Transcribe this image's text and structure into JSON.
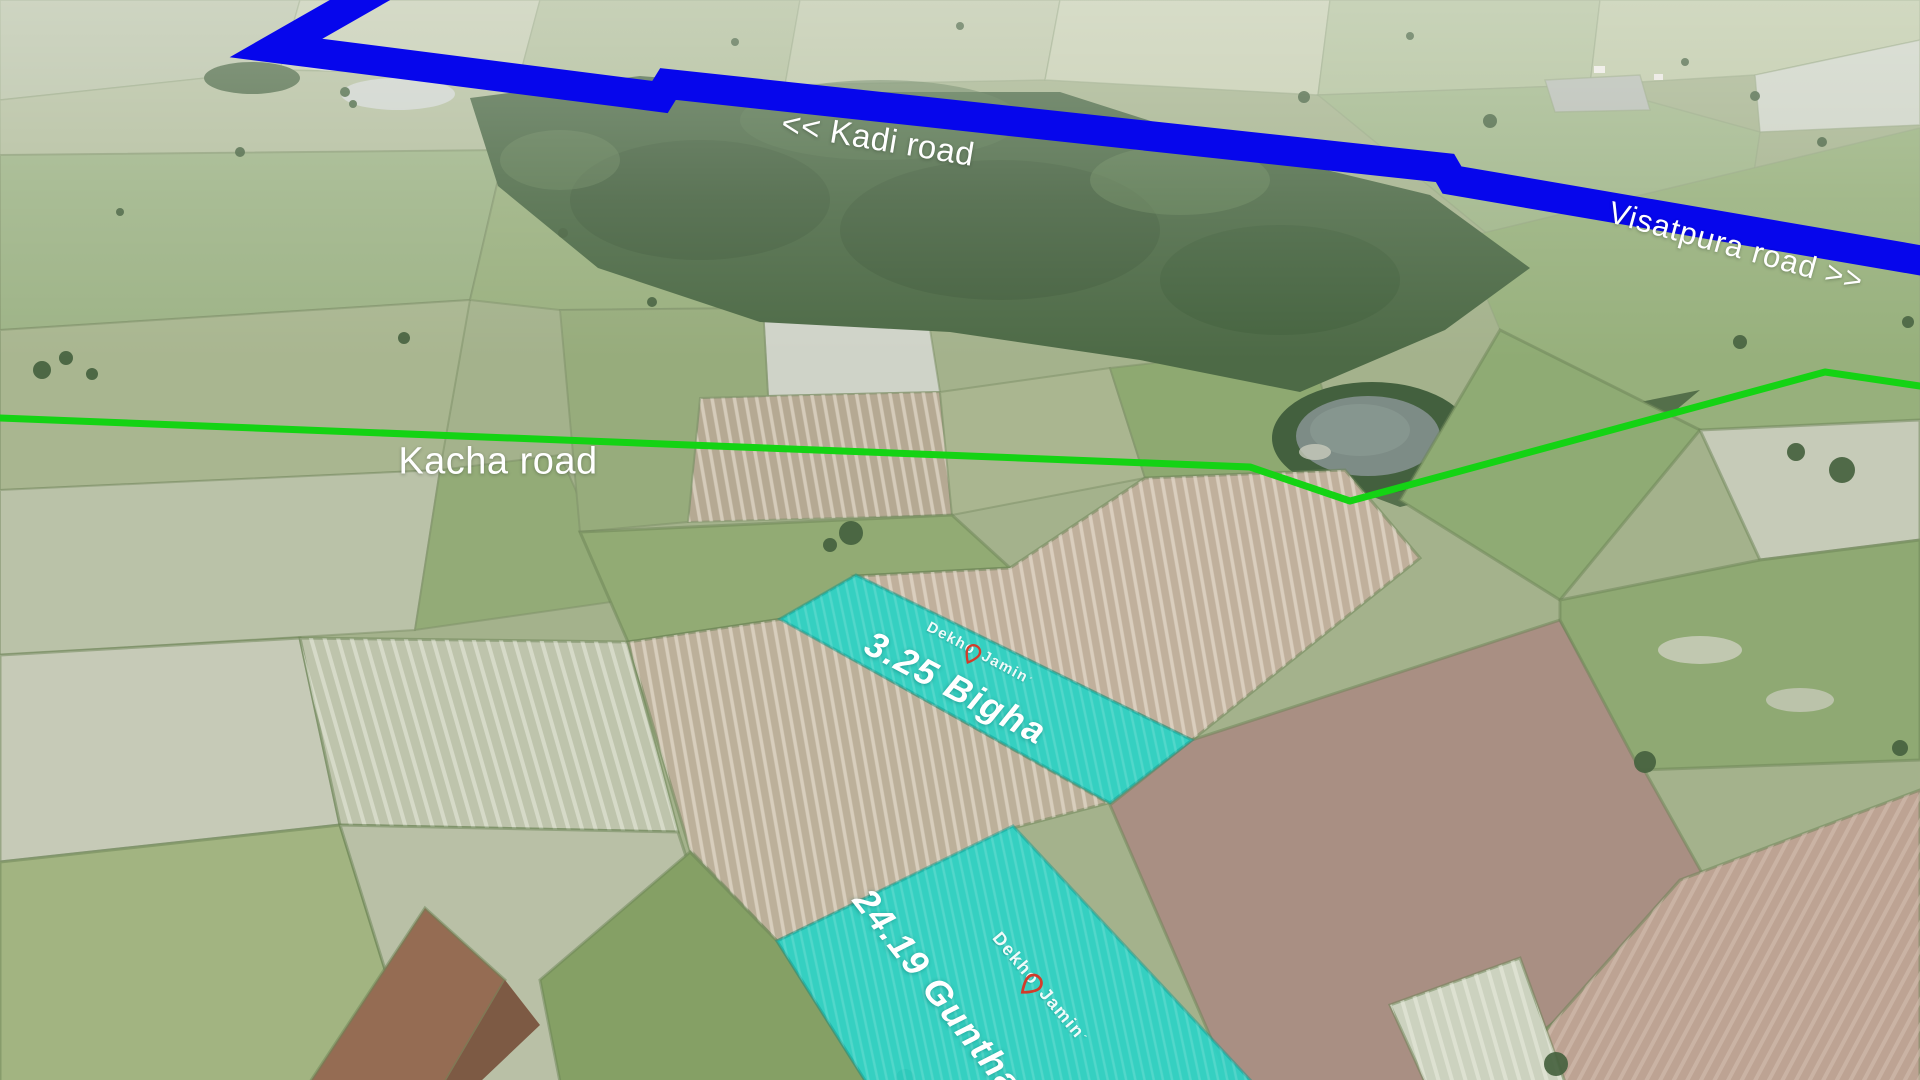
{
  "roads": {
    "blue_road": {
      "label_left": "<< Kadi road",
      "label_right": "Visatpura road >>",
      "color": "#0606ec"
    },
    "kacha": {
      "label": "Kacha road",
      "color": "#14d314"
    }
  },
  "plots": [
    {
      "area_label": "3.25 Bigha",
      "highlight_color": "#2bd2c5"
    },
    {
      "area_label": "24.19 Guntha",
      "highlight_color": "#2bd2c5"
    }
  ],
  "watermark": {
    "part1": "Dekho",
    "part2": "Jamin",
    "accent": "´",
    "pin_color": "#df2f1e",
    "text_color": "#ffffff"
  }
}
